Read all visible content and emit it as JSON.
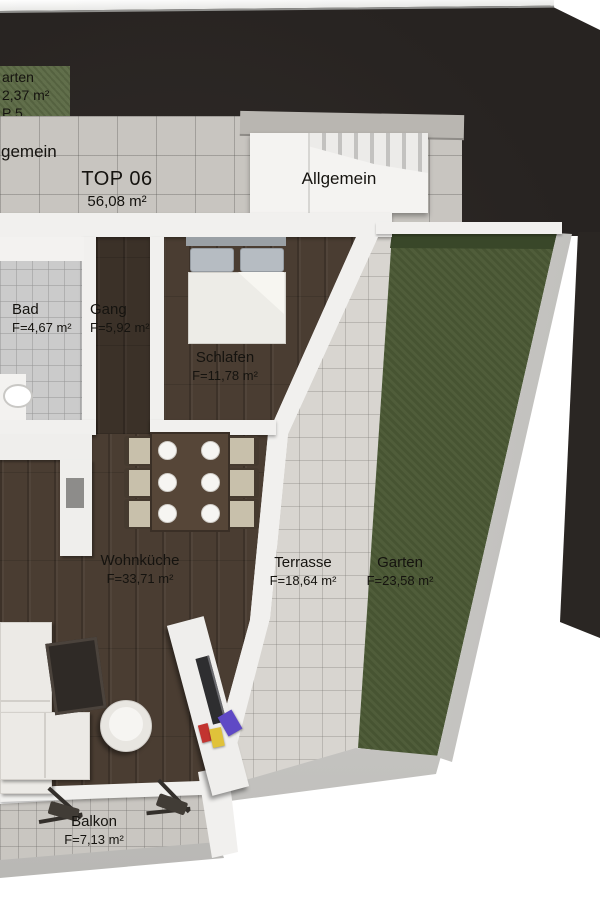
{
  "scene": {
    "kind": "3D apartment floor plan, top view",
    "unit_highlight": "TOP 06"
  },
  "palette": {
    "surround_dark": "#272321",
    "wall_white": "#f1f0ee",
    "wood_floor": "#4a3d32",
    "walkway_tile": "#c8c5c0",
    "terrace_tile": "#d8d5d0",
    "balcony_tile": "#c9c6c1",
    "bath_tile": "#cbcbcb",
    "lawn_green": "#4c5a36",
    "neighbor_lawn_green": "#5c6a45",
    "text": "#15130f",
    "book_red": "#c23430",
    "book_yellow": "#e0c23a",
    "book_purple": "#5f49c5"
  },
  "neighbor_unit": {
    "garten_fragment": "arten",
    "area_fragment": "2,37 m²",
    "unit_fragment": "P 5"
  },
  "common_area": {
    "walkway_fragment": "gemein",
    "stairwell_label": "Allgemein"
  },
  "unit": {
    "name": "TOP 06",
    "area": "56,08 m²"
  },
  "rooms": [
    {
      "name": "Bad",
      "area": "F=4,67 m²"
    },
    {
      "name": "Gang",
      "area": "F=5,92 m²"
    },
    {
      "name": "Schlafen",
      "area": "F=11,78 m²"
    },
    {
      "name": "Wohnküche",
      "area": "F=33,71 m²"
    },
    {
      "name": "Terrasse",
      "area": "F=18,64 m²"
    },
    {
      "name": "Garten",
      "area": "F=23,58 m²"
    },
    {
      "name": "Balkon",
      "area": "F=7,13 m²"
    }
  ]
}
